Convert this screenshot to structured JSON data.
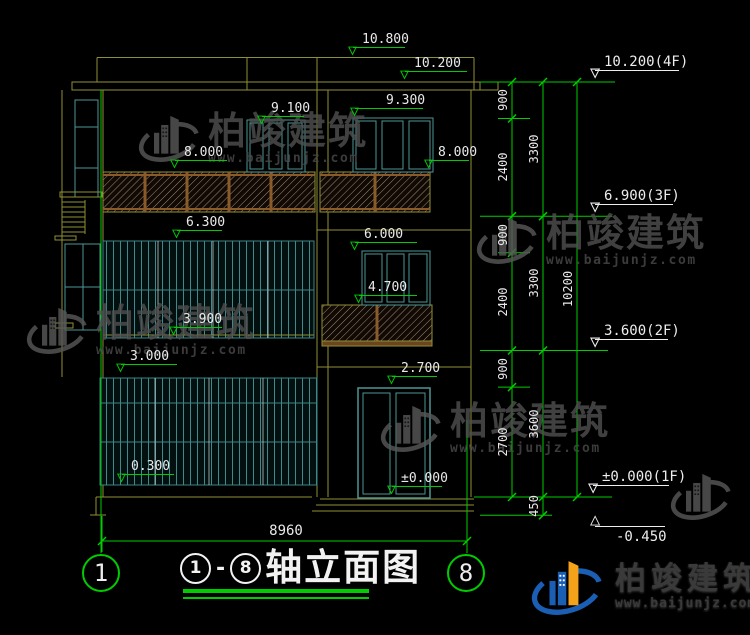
{
  "drawing_title": {
    "axis_from": "1",
    "separator": "-",
    "axis_to": "8",
    "name": "轴立面图"
  },
  "axis_bubbles": {
    "left": "1",
    "right": "8"
  },
  "bottom_dimension": "8960",
  "level_markers_building": [
    {
      "value": "10.800",
      "level": 10.8,
      "x": 356,
      "w": 52
    },
    {
      "value": "10.200",
      "level": 10.2,
      "x": 408,
      "w": 62
    },
    {
      "value": "9.300",
      "level": 9.3,
      "x": 358,
      "w": 68,
      "dx": 22
    },
    {
      "value": "9.100",
      "level": 9.1,
      "x": 265,
      "w": 42
    },
    {
      "value": "8.000",
      "level": 8.0,
      "x": 178,
      "w": 52
    },
    {
      "value": "8.000",
      "level": 8.0,
      "x": 432,
      "w": 40
    },
    {
      "value": "6.300",
      "level": 6.3,
      "x": 180,
      "w": 45
    },
    {
      "value": "6.000",
      "level": 6.0,
      "x": 358,
      "w": 62
    },
    {
      "value": "4.700",
      "level": 4.7,
      "x": 362,
      "w": 58
    },
    {
      "value": "3.900",
      "level": 3.9,
      "x": 177,
      "w": 48
    },
    {
      "value": "3.000",
      "level": 3.0,
      "x": 124,
      "w": 56
    },
    {
      "value": "2.700",
      "level": 2.7,
      "x": 395,
      "w": 45
    },
    {
      "value": "0.300",
      "level": 0.3,
      "x": 125,
      "w": 52
    },
    {
      "value": "±0.000",
      "level": 0.0,
      "x": 395,
      "w": 50
    }
  ],
  "floor_markers_right": [
    {
      "value": "10.200(4F)",
      "level": 10.2,
      "x": 598,
      "w": 84
    },
    {
      "value": "6.900(3F)",
      "level": 6.9,
      "x": 598,
      "w": 78
    },
    {
      "value": "3.600(2F)",
      "level": 3.6,
      "x": 598,
      "w": 73
    },
    {
      "value": "±0.000(1F)",
      "level": 0.0,
      "x": 596,
      "w": 76
    },
    {
      "value": "-0.450",
      "level": -0.45,
      "x": 598,
      "w": 70,
      "flip": true
    }
  ],
  "dimension_columns": [
    {
      "x": 512,
      "labels": [
        {
          "t": "900",
          "c": 9.75
        },
        {
          "t": "2400",
          "c": 8.1
        },
        {
          "t": "900",
          "c": 6.45
        },
        {
          "t": "2400",
          "c": 4.8
        },
        {
          "t": "900",
          "c": 3.15
        },
        {
          "t": "2700",
          "c": 1.35
        }
      ]
    },
    {
      "x": 543,
      "labels": [
        {
          "t": "3300",
          "c": 8.55
        },
        {
          "t": "3300",
          "c": 5.25
        },
        {
          "t": "3600",
          "c": 1.8
        },
        {
          "t": "450",
          "c": -0.225
        }
      ]
    },
    {
      "x": 577,
      "labels": [
        {
          "t": "10200",
          "c": 5.1
        }
      ]
    }
  ],
  "watermark": {
    "brand": "柏竣建筑",
    "url": "www.baijunjz.com"
  },
  "brand_logo": {
    "brand": "柏竣建筑",
    "url": "www.baijunjz.com"
  },
  "colors": {
    "dim_green": "#00CC00",
    "wall_yellow": "#8F8F33",
    "frame_teal": "#4D9696",
    "text_white": "#E9E9E9",
    "watermark_gray": "#4F4F4F",
    "brand_blue": "#1B5FB5",
    "brand_orange": "#F5A21B"
  }
}
